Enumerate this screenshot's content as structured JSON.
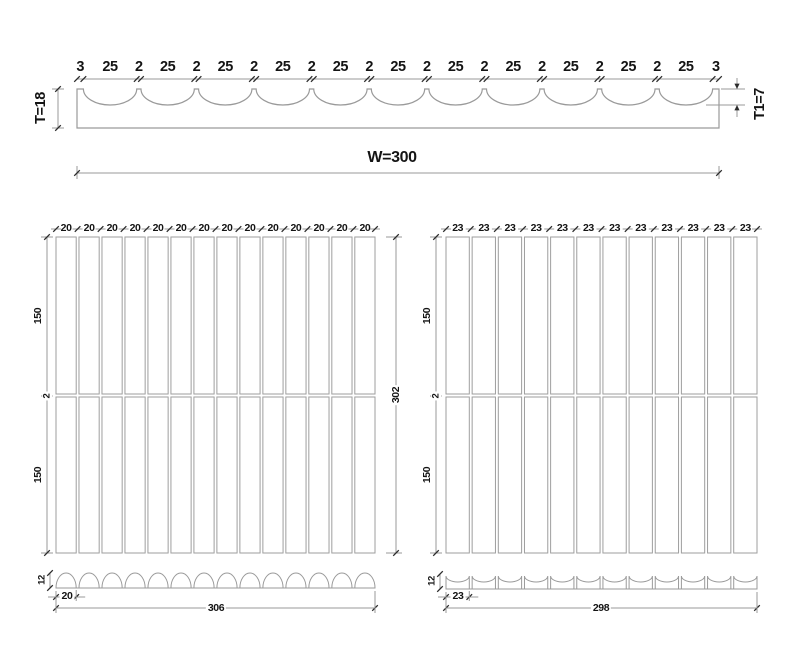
{
  "colors": {
    "background": "#ffffff",
    "line": "#9a9a9a",
    "tile_border": "#9e9e9e",
    "tick": "#2b2b2b",
    "text": "#141414"
  },
  "top_section": {
    "dim_sequence": [
      "3",
      "25",
      "2",
      "25",
      "2",
      "25",
      "2",
      "25",
      "2",
      "25",
      "2",
      "25",
      "2",
      "25",
      "2",
      "25",
      "2",
      "25",
      "2",
      "25",
      "2",
      "25",
      "3"
    ],
    "scallop_count": 11,
    "thickness_label": "T=18",
    "edge_thickness_label": "T1=7",
    "width_label": "W=300"
  },
  "left_panel": {
    "column_labels": [
      "20",
      "20",
      "20",
      "20",
      "20",
      "20",
      "20",
      "20",
      "20",
      "20",
      "20",
      "20",
      "20",
      "20"
    ],
    "column_count": 14,
    "row_count": 2,
    "side_dims": [
      "150",
      "2",
      "150"
    ],
    "overall_height_label": "302",
    "profile": {
      "hump_style": "semicircle",
      "hump_count": 14,
      "height_label": "12",
      "unit_width_label": "20",
      "overall_width_label": "306"
    }
  },
  "right_panel": {
    "column_labels": [
      "23",
      "23",
      "23",
      "23",
      "23",
      "23",
      "23",
      "23",
      "23",
      "23",
      "23",
      "23"
    ],
    "column_count": 12,
    "row_count": 2,
    "side_dims": [
      "150",
      "2",
      "150"
    ],
    "profile": {
      "hump_style": "concave",
      "hump_count": 12,
      "height_label": "12",
      "unit_width_label": "23",
      "overall_width_label": "298"
    }
  }
}
